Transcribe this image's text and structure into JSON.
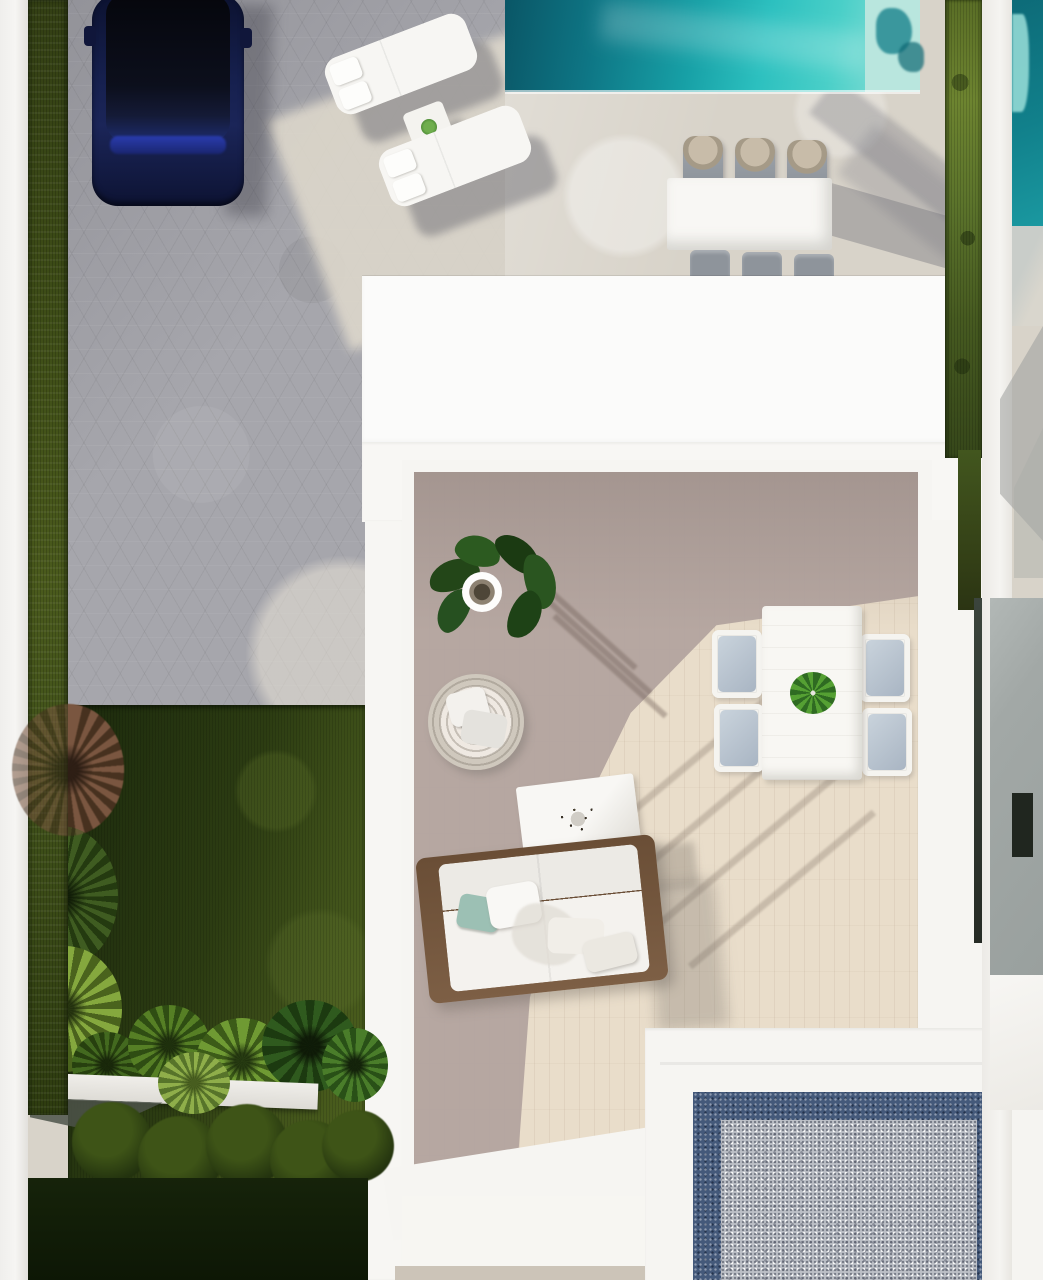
{
  "scene": {
    "type": "aerial-architectural-render",
    "description": "Top-down 3D render of a modern villa plot: gray paver driveway with a navy SUV, two white sun loungers with a side table, a turquoise swimming pool with a white six-chair dining set on a cream deck, a white flat-roof villa with an inner roof terrace (potted plant, round rattan chair, white coffee table, wood-base sofa with cushions, white dining table with four blue-gray chairs), a dark lawn garden with tropical plants, white planter ledge and clipped hedge balls, a blue-bordered gravel patio at bottom right, and a neighbor strip with its own pool and gray wall along the right edge.",
    "orientation": "top-down",
    "lighting": "hard sun from upper-left casting long diagonal shadows to lower-right"
  },
  "palette": {
    "deckCream": "#d8d3c9",
    "paverGray": "#a6a6ac",
    "roofWhite": "#fbfbfa",
    "floorSun": "#e9ddca",
    "floorShadow": "#b1a39e",
    "poolDeep": "#0a5666",
    "poolBright": "#2cc0bf",
    "poolPale": "#b9e6de",
    "grassDark": "#2e3c10",
    "grassLight": "#6d8430",
    "lawnDeep": "#16230a",
    "gravelBlue": "#44597a",
    "gravelLight": "#bcbfc6",
    "rattanTan": "#c8bca9",
    "chairGray": "#8e949b",
    "seatBlue": "#b8c4d2",
    "sagePillow": "#9cc0b4",
    "woodBrown": "#6d5139",
    "carBody": "#16204e",
    "carGlass": "#07080f",
    "carBlue": "#2a3cae",
    "grayWall": "#a2a8a6",
    "darkSlot": "#20261f",
    "ledgeWhite": "#e9e7e2"
  },
  "objects": [
    {
      "name": "boundary-wall-left",
      "description": "white perimeter wall strip, full height"
    },
    {
      "name": "grass-strip",
      "description": "narrow dark green lawn strip along left wall"
    },
    {
      "name": "driveway",
      "description": "gray hexagonal paver driveway, partly in shadow"
    },
    {
      "name": "car",
      "description": "dark navy SUV parked vertically, black glass roof, blue windshield band",
      "count": 1
    },
    {
      "name": "sun-loungers",
      "description": "white loungers rotated about -21 degrees with two head pillows each",
      "count": 2
    },
    {
      "name": "lounger-side-table",
      "description": "small white square table with green potted plant",
      "count": 1
    },
    {
      "name": "swimming-pool",
      "description": "turquoise pool along top edge, dark deep end left, pale step at right end"
    },
    {
      "name": "poolside-dining-set",
      "description": "white rectangular table with three rattan-back gray chairs above and three below",
      "chairs": 6
    },
    {
      "name": "villa-roof",
      "description": "large white flat roof blocks of the villa"
    },
    {
      "name": "roof-terrace",
      "description": "inner terrace with wood-plank floor, half in shadow"
    },
    {
      "name": "potted-plant",
      "description": "fiddle-leaf plant in round white pot casting streak shadows",
      "count": 1
    },
    {
      "name": "rattan-chair",
      "description": "round woven chair with two pale cushions",
      "count": 1
    },
    {
      "name": "coffee-table",
      "description": "white table with dried-twig centerpiece",
      "count": 1
    },
    {
      "name": "sofa",
      "description": "white cushion sofa on wood base with sage and white pillows",
      "count": 1
    },
    {
      "name": "terrace-dining-set",
      "description": "white plank table with green plant and four blue-gray seat chairs",
      "chairs": 4
    },
    {
      "name": "garden",
      "description": "dark lawn with cordyline, fern, bright palm and tropical leaf clusters"
    },
    {
      "name": "planter-ledge",
      "description": "white ledge crossing the garden",
      "count": 1
    },
    {
      "name": "hedge-balls",
      "description": "clipped round hedges below the ledge",
      "count": 5
    },
    {
      "name": "gravel-patio",
      "description": "bottom-right court of light gravel framed by dark blue gravel border and white edge"
    },
    {
      "name": "hedge-divider",
      "description": "olive hedge strip between villa deck and neighbor plot"
    },
    {
      "name": "neighbor-pool",
      "description": "sliver of neighbor teal pool at top right corner"
    },
    {
      "name": "neighbor-gray-wall",
      "description": "gray neighbor wall with dark window slot on right edge"
    }
  ]
}
